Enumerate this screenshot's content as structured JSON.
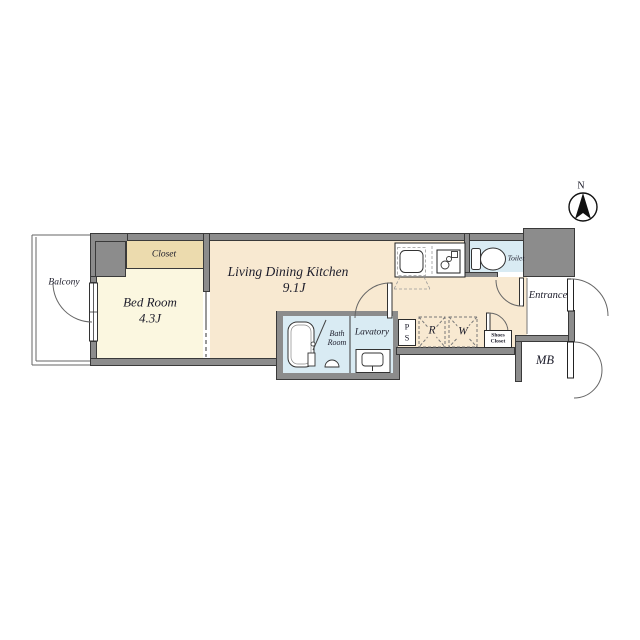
{
  "compass": {
    "label": "N"
  },
  "rooms": {
    "balcony": {
      "label": "Balcony"
    },
    "bedroom": {
      "label": "Bed Room",
      "size": "4.3J"
    },
    "closet": {
      "label": "Closet"
    },
    "ldk": {
      "label": "Living Dining Kitchen",
      "size": "9.1J"
    },
    "toilet": {
      "label": "Toilet"
    },
    "bath": {
      "label": "Bath Room"
    },
    "lavatory": {
      "label": "Lavatory"
    },
    "pipe_space": {
      "label": "PS"
    },
    "refrigerator": {
      "label": "R"
    },
    "washer": {
      "label": "W"
    },
    "shoes_closet": {
      "label": "Shoes Closet"
    },
    "entrance": {
      "label": "Entrance"
    },
    "meter_box": {
      "label": "MB"
    }
  },
  "colors": {
    "wall": "#8c8c8c",
    "ldk_floor": "#f8e9d1",
    "bedroom_floor": "#fbf7e0",
    "closet_floor": "#ecdbae",
    "wet_floor": "#d9ebf3",
    "line": "#3a3a3a"
  }
}
